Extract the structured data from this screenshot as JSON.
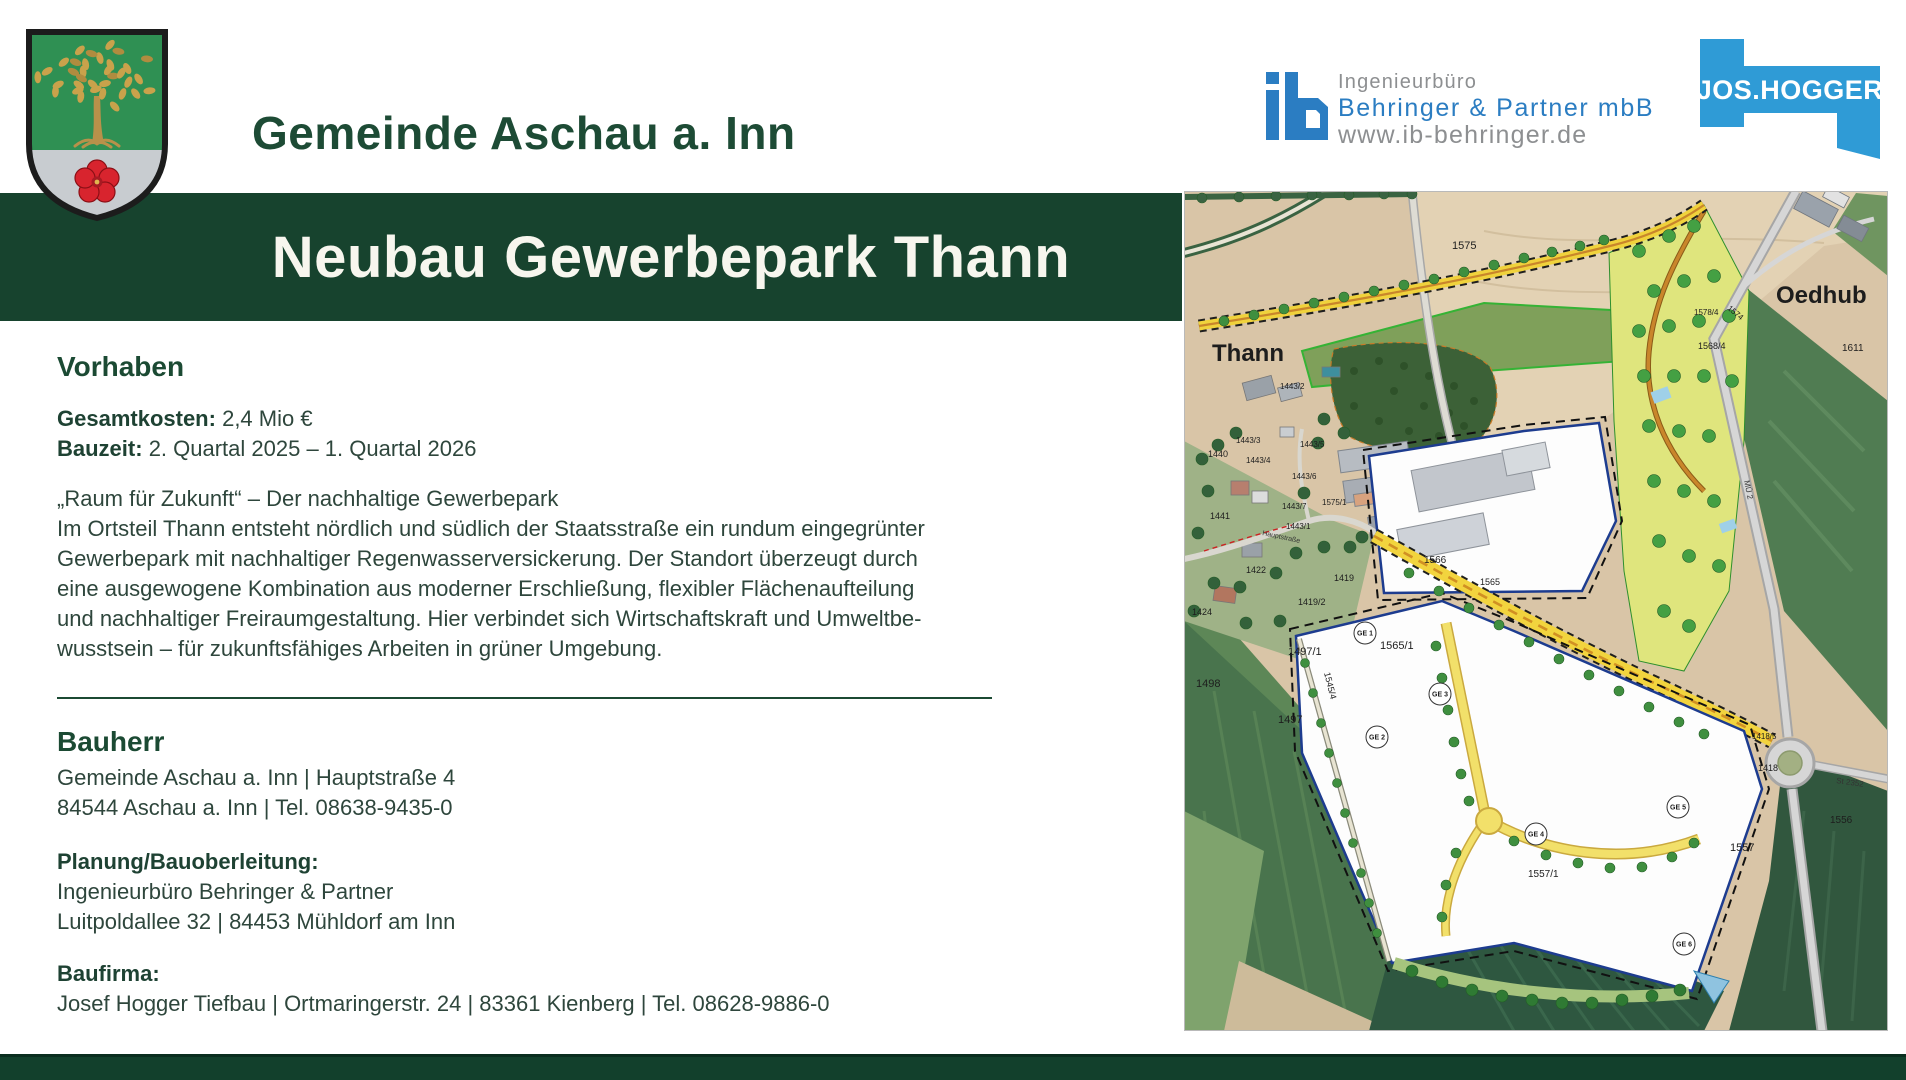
{
  "header": {
    "municipality": "Gemeinde Aschau a. Inn",
    "ib_logo": {
      "line1": "Ingenieurbüro",
      "line2": "Behringer & Partner mbB",
      "line3": "www.ib-behringer.de",
      "blue": "#2b7dc2",
      "gray": "#8d8f91"
    },
    "hogger_logo": {
      "text": "JOS.HOGGER",
      "blue": "#2f9bd6"
    }
  },
  "banner": {
    "title": "Neubau Gewerbepark Thann",
    "bg": "#17432e"
  },
  "sections": {
    "vorhaben": {
      "heading": "Vorhaben",
      "facts": [
        {
          "label": "Gesamtkosten:",
          "value": "2,4 Mio €"
        },
        {
          "label": "Bauzeit:",
          "value": "2. Quartal 2025 – 1. Quartal 2026"
        }
      ],
      "about_lines": [
        "„Raum für Zukunft“ – Der nachhaltige Gewerbepark",
        "Im Ortsteil Thann entsteht nördlich und südlich der Staatsstraße ein rundum eingegrünter",
        "Gewerbepark mit nachhaltiger Regenwasserversickerung. Der Standort überzeugt durch",
        "eine ausgewogene Kombination aus moderner Erschließung, flexibler Flächenaufteilung",
        "und nachhaltiger Freiraumgestaltung. Hier verbindet sich Wirtschaftskraft und Umweltbe-",
        "wusstsein – für zukunftsfähiges Arbeiten in grüner Umgebung."
      ]
    },
    "bauherr": {
      "heading": "Bauherr",
      "lines": [
        "Gemeinde Aschau a. Inn | Hauptstraße 4",
        "84544 Aschau a. Inn | Tel. 08638-9435-0"
      ]
    },
    "planung": {
      "label": "Planung/Bauoberleitung:",
      "lines": [
        "Ingenieurbüro Behringer & Partner",
        "Luitpoldallee 32 | 84453 Mühldorf am Inn"
      ]
    },
    "baufirma": {
      "label": "Baufirma:",
      "lines": [
        "Josef Hogger Tiefbau | Ortmaringerstr. 24 | 83361 Kienberg | Tel. 08628-9886-0"
      ]
    }
  },
  "map": {
    "place_labels": [
      {
        "text": "Thann",
        "x": 28,
        "y": 170
      },
      {
        "text": "Oedhub",
        "x": 592,
        "y": 112
      }
    ],
    "parcel_labels": [
      {
        "text": "1575",
        "x": 268,
        "y": 58,
        "s": 11
      },
      {
        "text": "1611",
        "x": 658,
        "y": 160,
        "s": 10
      },
      {
        "text": "1578/4",
        "x": 510,
        "y": 124,
        "s": 8
      },
      {
        "text": "1568/4",
        "x": 514,
        "y": 158,
        "s": 9
      },
      {
        "text": "1574",
        "x": 543,
        "y": 118,
        "s": 8,
        "r": 40
      },
      {
        "text": "1566",
        "x": 240,
        "y": 372,
        "s": 10
      },
      {
        "text": "1565",
        "x": 296,
        "y": 394,
        "s": 9
      },
      {
        "text": "1565/1",
        "x": 196,
        "y": 458,
        "s": 11
      },
      {
        "text": "1419",
        "x": 150,
        "y": 390,
        "s": 9
      },
      {
        "text": "1419/2",
        "x": 114,
        "y": 414,
        "s": 9
      },
      {
        "text": "1422",
        "x": 62,
        "y": 382,
        "s": 9
      },
      {
        "text": "1424",
        "x": 8,
        "y": 424,
        "s": 9
      },
      {
        "text": "1440",
        "x": 24,
        "y": 266,
        "s": 9
      },
      {
        "text": "1441",
        "x": 26,
        "y": 328,
        "s": 9
      },
      {
        "text": "1443/2",
        "x": 96,
        "y": 198,
        "s": 8
      },
      {
        "text": "1443/3",
        "x": 52,
        "y": 252,
        "s": 8
      },
      {
        "text": "1443/5",
        "x": 116,
        "y": 256,
        "s": 8
      },
      {
        "text": "1443/4",
        "x": 62,
        "y": 272,
        "s": 8
      },
      {
        "text": "1443/6",
        "x": 108,
        "y": 288,
        "s": 8
      },
      {
        "text": "1443/7",
        "x": 98,
        "y": 318,
        "s": 8
      },
      {
        "text": "1443/1",
        "x": 102,
        "y": 338,
        "s": 8
      },
      {
        "text": "1575/1",
        "x": 138,
        "y": 314,
        "s": 8
      },
      {
        "text": "1497/1",
        "x": 104,
        "y": 464,
        "s": 11
      },
      {
        "text": "1498",
        "x": 12,
        "y": 496,
        "s": 11
      },
      {
        "text": "1497",
        "x": 94,
        "y": 532,
        "s": 11
      },
      {
        "text": "1545/4",
        "x": 140,
        "y": 482,
        "s": 9,
        "r": 76
      },
      {
        "text": "1557",
        "x": 546,
        "y": 660,
        "s": 11
      },
      {
        "text": "1557/1",
        "x": 344,
        "y": 686,
        "s": 10
      },
      {
        "text": "1556",
        "x": 646,
        "y": 632,
        "s": 10
      },
      {
        "text": "1418",
        "x": 574,
        "y": 580,
        "s": 9
      },
      {
        "text": "1418/5",
        "x": 568,
        "y": 548,
        "s": 8
      }
    ],
    "ge_labels": [
      {
        "text": "GE 1",
        "x": 181,
        "y": 442
      },
      {
        "text": "GE 2",
        "x": 193,
        "y": 546
      },
      {
        "text": "GE 3",
        "x": 256,
        "y": 503
      },
      {
        "text": "GE 4",
        "x": 352,
        "y": 643
      },
      {
        "text": "GE 5",
        "x": 494,
        "y": 616
      },
      {
        "text": "GE 6",
        "x": 500,
        "y": 753
      }
    ],
    "road_labels": [
      {
        "text": "St 2352",
        "x": 652,
        "y": 592,
        "r": 8,
        "s": 8
      },
      {
        "text": "MÜ 2",
        "x": 560,
        "y": 290,
        "r": 78,
        "s": 8
      },
      {
        "text": "Hauptstraße",
        "x": 78,
        "y": 344,
        "r": 12,
        "s": 7
      }
    ]
  }
}
